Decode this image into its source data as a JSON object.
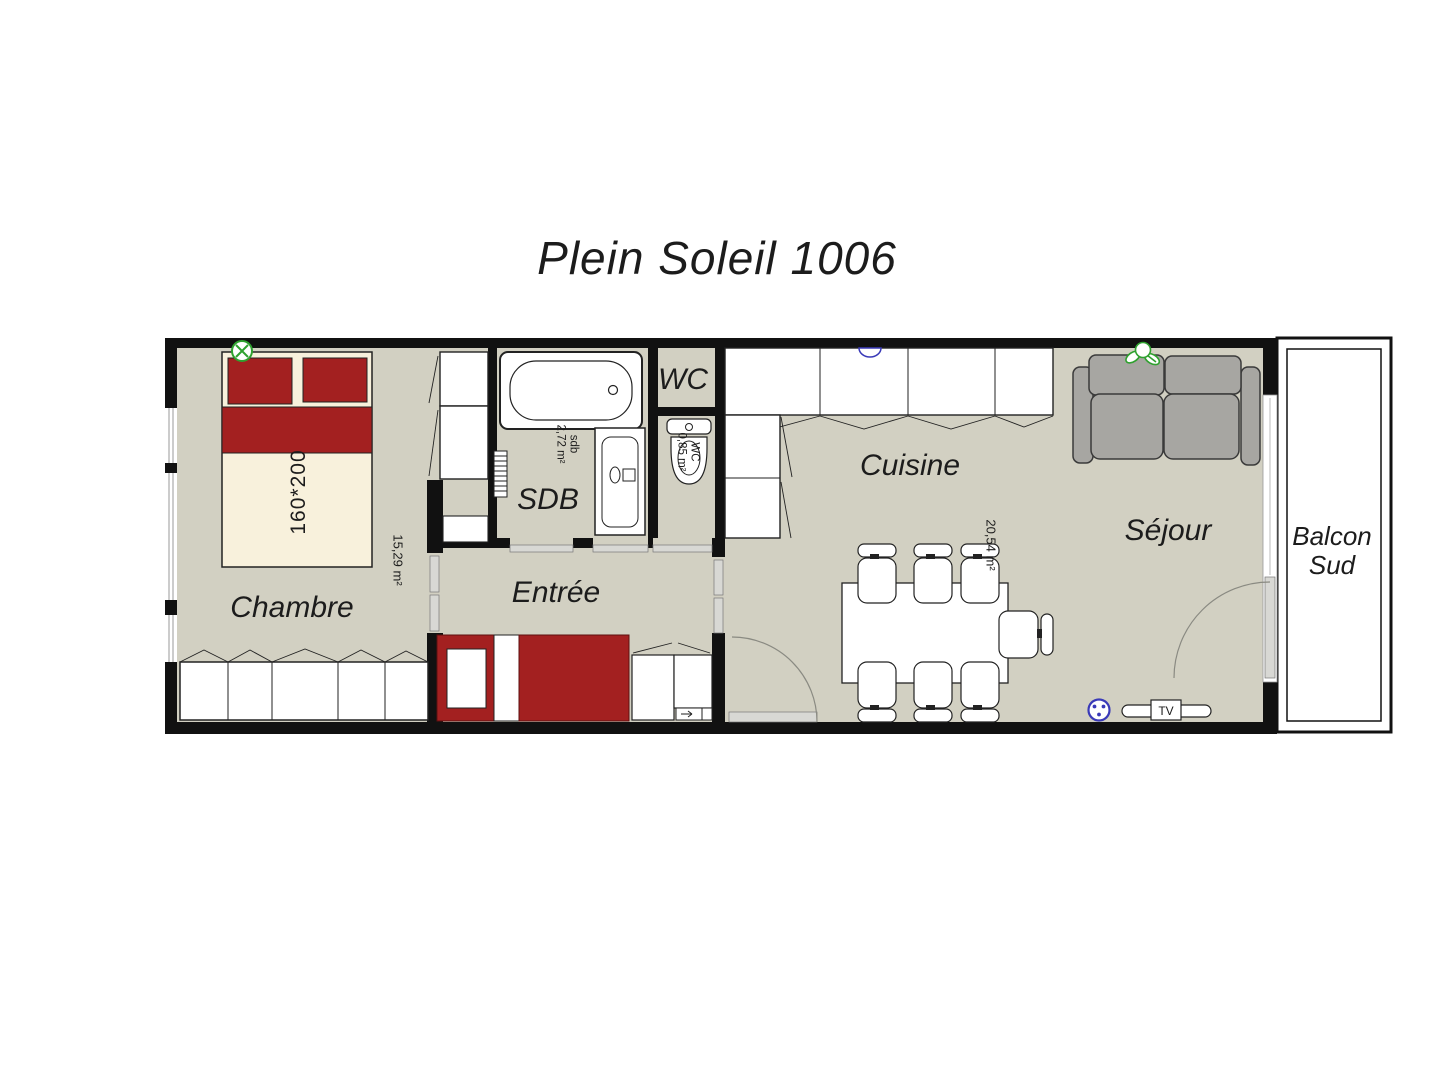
{
  "title": "Plein Soleil 1006",
  "rooms": {
    "chambre": {
      "label": "Chambre",
      "area": "15,29 m²"
    },
    "sdb": {
      "label": "SDB",
      "area": "sdb\n2,72 m²"
    },
    "wc": {
      "label": "WC",
      "area": "WC\n0,85 m²"
    },
    "entree": {
      "label": "Entrée"
    },
    "cuisine": {
      "label": "Cuisine",
      "area": "20,54 m²"
    },
    "sejour": {
      "label": "Séjour"
    },
    "balcon": {
      "label": "Balcon\nSud"
    }
  },
  "furniture": {
    "bed_size": "160*200",
    "tv_label": "TV"
  },
  "colors": {
    "wall": "#111111",
    "floor": "#d2d0c2",
    "accent_red": "#a32020",
    "bed_cream": "#f8f1dc",
    "sofa_gray": "#a7a6a2",
    "door_gray": "#d8d8d4",
    "symbol_green": "#2fa12f",
    "symbol_blue": "#3a3ab8"
  }
}
